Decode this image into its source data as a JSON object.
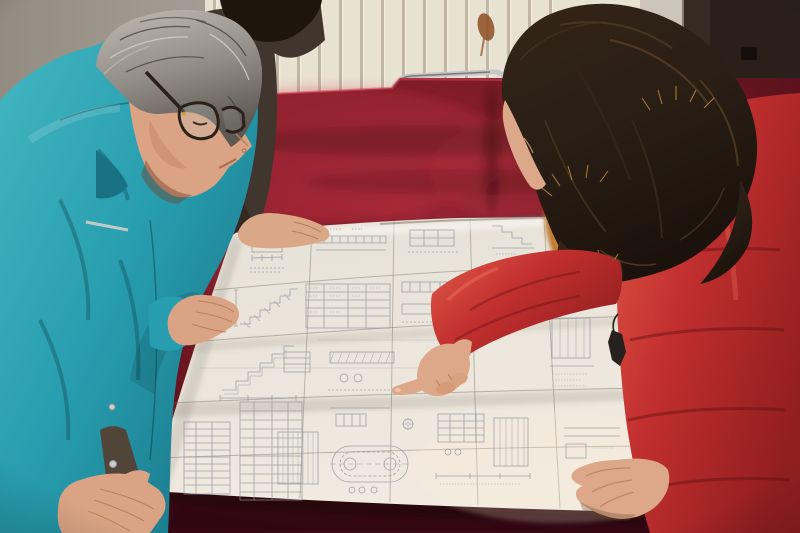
{
  "scene": {
    "title": "Photograph: two workers reviewing a large folded construction blueprint spread on a dark-red velvet table",
    "description": "A gray-haired man in a teal work jacket with glasses leans over a large white engineering drawing laid on a crimson velvet-covered table while a woman in a red down coat with an orange fur-trimmed hood and long dark hair points at a detail on the blueprint. A second person in a dark jacket stands behind, one hand on the paper. Background: cream slatted radiator panel, gray wall, dark door, metal-framed chair with red seat."
  },
  "colors": {
    "wall": "#a8a49b",
    "wall_shadow": "#8f8b82",
    "radiator": "#e8e4d6",
    "radiator_slat": "#b5af9e",
    "wall_strip": "#c9c6bd",
    "door": "#221b15",
    "door_latch": "#0c0907",
    "rust_stain": "#8a4a20",
    "chrome": "#c3c7ca",
    "chair_seat": "#8e1e2c",
    "velvet_bright": "#97202f",
    "velvet_mid": "#6e1120",
    "velvet_dark": "#470a14",
    "velvet_deep": "#2a0409",
    "velvet_fold": "#a32336",
    "paper_top": "#e6e3da",
    "paper_bottom": "#f0ede5",
    "blueprint_line": "#8e96a2",
    "jacket_teal": "#1f9db1",
    "jacket_teal_dark": "#0f7085",
    "jacket_teal_light": "#3cb6c4",
    "inner_sleeve": "#4a4036",
    "snap_silver": "#ccd2d4",
    "man_skin": "#d8a385",
    "man_hair": "#8d8b86",
    "man_hair_light": "#bdbbb5",
    "man_hair_dark": "#575550",
    "glasses_frame": "#241c14",
    "p2_jacket": "#39312a",
    "p2_jacket_dark": "#2b241e",
    "p2_hair": "#151008",
    "p2_skin": "#d9a888",
    "woman_hair": "#221911",
    "woman_hair_light": "#55402a",
    "fur_orange": "#c87f2e",
    "fur_orange_bright": "#eaa83e",
    "coat_red": "#c02a2c",
    "coat_red_dark": "#8e191d",
    "coat_red_light": "#e05a48",
    "woman_skin": "#dba88a",
    "zipper": "#1f1b18"
  }
}
